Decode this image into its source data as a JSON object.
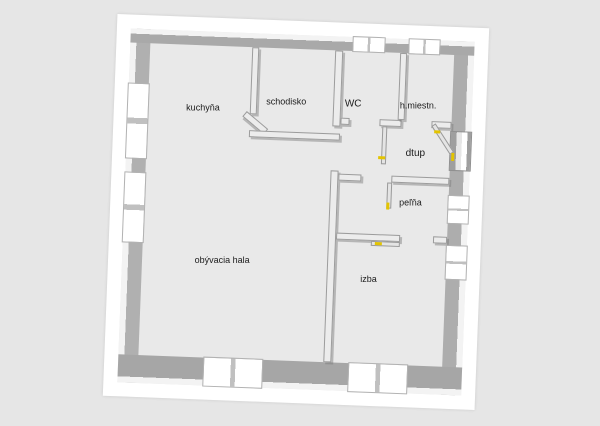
{
  "colors": {
    "background": "#e6e6e6",
    "paper": "#ffffff",
    "floor": "#e9e9e9",
    "wall_inner_face": "#a9a9a9",
    "wall_top_face": "#f3f3f3",
    "door_handle": "#e3c400",
    "label_text": "#1c1c1c"
  },
  "rooms": {
    "kuchyna": {
      "label": "kuchyňa"
    },
    "schodisko": {
      "label": "schodisko"
    },
    "wc": {
      "label": "WC"
    },
    "miestnost": {
      "label": "h.miestn."
    },
    "vstup": {
      "label": "dtup"
    },
    "kupelna": {
      "label": "peľňa"
    },
    "hala": {
      "label": "obývacia hala"
    },
    "izba": {
      "label": "izba"
    }
  }
}
